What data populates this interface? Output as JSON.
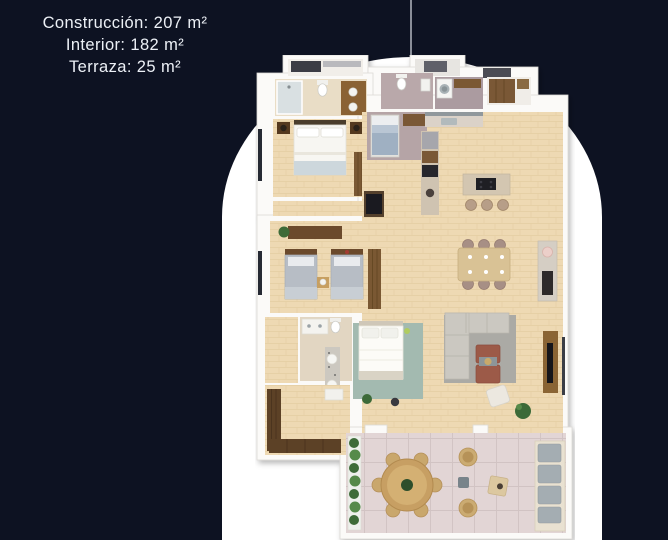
{
  "stats": {
    "lines": [
      {
        "label": "Construcción",
        "value": "207 m²",
        "text": "Construcción: 207 m²"
      },
      {
        "label": "Interior",
        "value": "182 m²",
        "text": "Interior: 182 m²"
      },
      {
        "label": "Terraza",
        "value": "25 m²",
        "text": "Terraza: 25 m²"
      }
    ]
  },
  "palette": {
    "background": "#0d1222",
    "text": "#ecf0f6",
    "arch": "#ffffff",
    "divider_line": "#8a8e99",
    "wall_white": "#fbfaf8",
    "wood_floor": "#eed9b3",
    "tile_bath_beige": "#e9ddc6",
    "tile_gray_mauve": "#b5a4a6",
    "tile_terrace_pink": "#e2d5d5",
    "wood_dark_cabinet": "#7a5833",
    "sofa_gray": "#cbc8c1",
    "rug_gray": "#abaaa5",
    "coffee_table_terracotta": "#9c5a48",
    "bed_linen_white": "#f7f6f2",
    "twin_bed_gray": "#b7bdc5",
    "rug_teal": "#a3bab0",
    "plant_green": "#3e6b38"
  },
  "floor_plan": {
    "rooms": [
      "closet-top",
      "master-bathroom",
      "master-bedroom",
      "guest-bathroom",
      "service-bedroom",
      "entry",
      "laundry",
      "pantry",
      "kitchen",
      "dining-area",
      "bar-counter",
      "living-room",
      "twin-bedroom",
      "bathroom-3",
      "dressing-room",
      "bedroom-3",
      "terrace"
    ]
  }
}
